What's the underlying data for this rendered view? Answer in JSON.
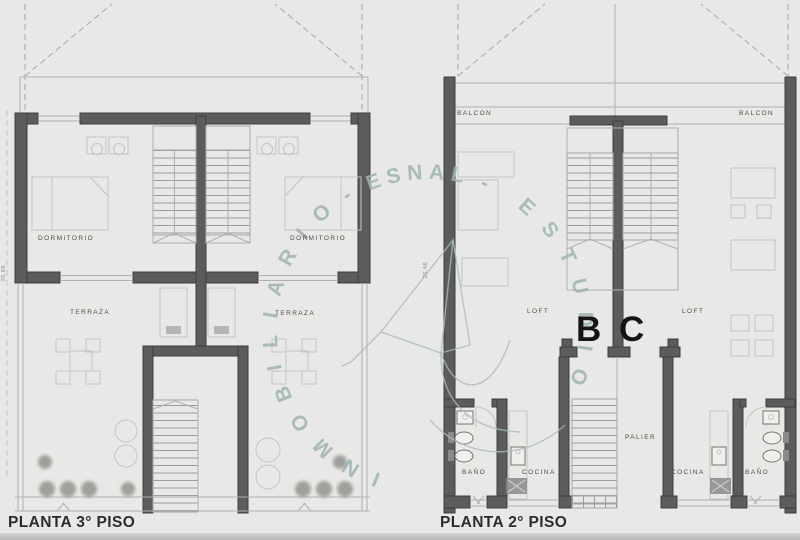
{
  "plans": {
    "plan3": {
      "title": "PLANTA 3° PISO",
      "dimension": "25.66",
      "labels": {
        "dormitorio_left": "DORMITORIO",
        "dormitorio_right": "DORMITORIO",
        "terraza_left": "TERRAZA",
        "terraza_right": "TERRAZA"
      }
    },
    "plan2": {
      "title": "PLANTA 2° PISO",
      "dimension": "25.46",
      "labels": {
        "balcon_left": "BALCON",
        "balcon_right": "BALCON",
        "loft_left": "LOFT",
        "loft_right": "LOFT",
        "unit_b": "B",
        "unit_c": "C",
        "palier": "PALIER",
        "bano_left": "BAÑO",
        "cocina_left": "COCINA",
        "cocina_right": "COCINA",
        "bano_right": "BAÑO"
      }
    }
  },
  "watermark": {
    "arc_top": "- ESNAL -",
    "arc_right": "ESTUDIO",
    "arc_left": "INMOBILIARIO",
    "color": "#9fb3b4"
  },
  "colors": {
    "background": "#e8e8e6",
    "wall": "#5c5c5c",
    "thin_line": "#b0b0ae",
    "label_text": "#4c4c46",
    "title_text": "#2c2c2a",
    "unit_letter": "#141414"
  }
}
